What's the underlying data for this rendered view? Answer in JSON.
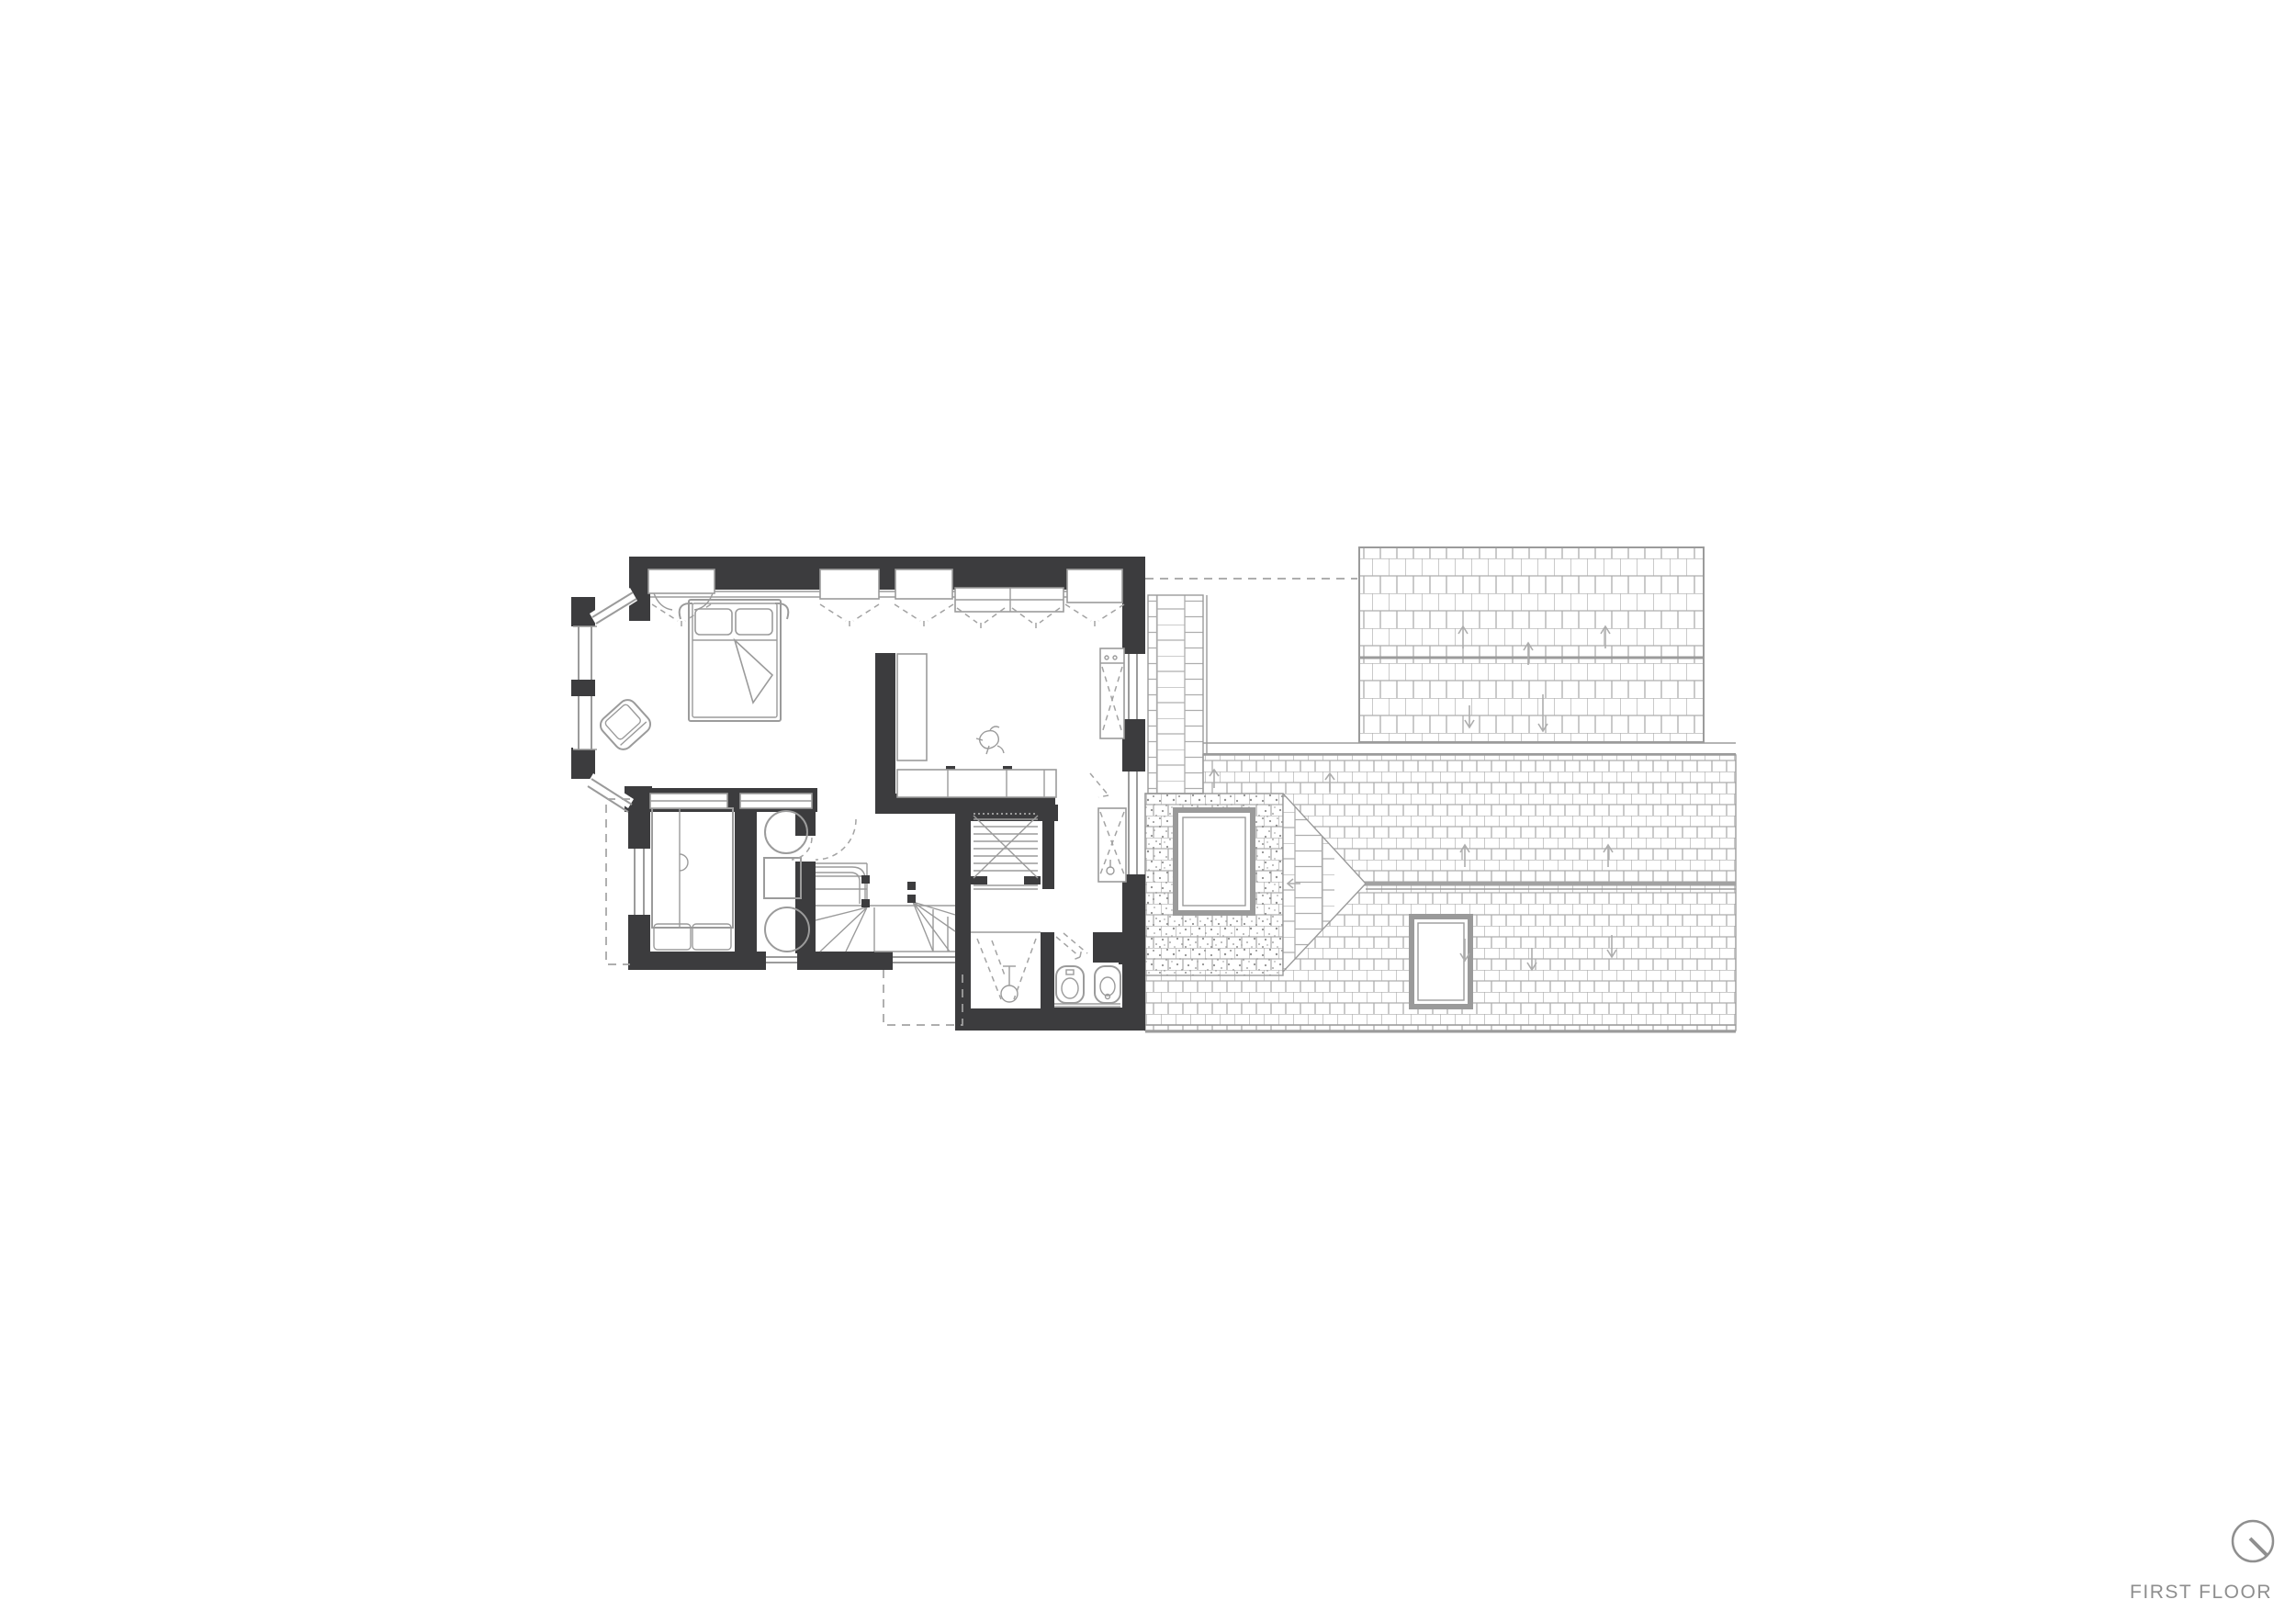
{
  "title_block": {
    "label": "FIRST FLOOR",
    "orientation_icon": "north-indicator-icon"
  },
  "palette": {
    "paper": "#ffffff",
    "wall": "#3c3c3e",
    "line": "#9b9b9b",
    "line_light": "#adadad",
    "dash": "#a3a3a3",
    "text": "#8e8e8e"
  }
}
